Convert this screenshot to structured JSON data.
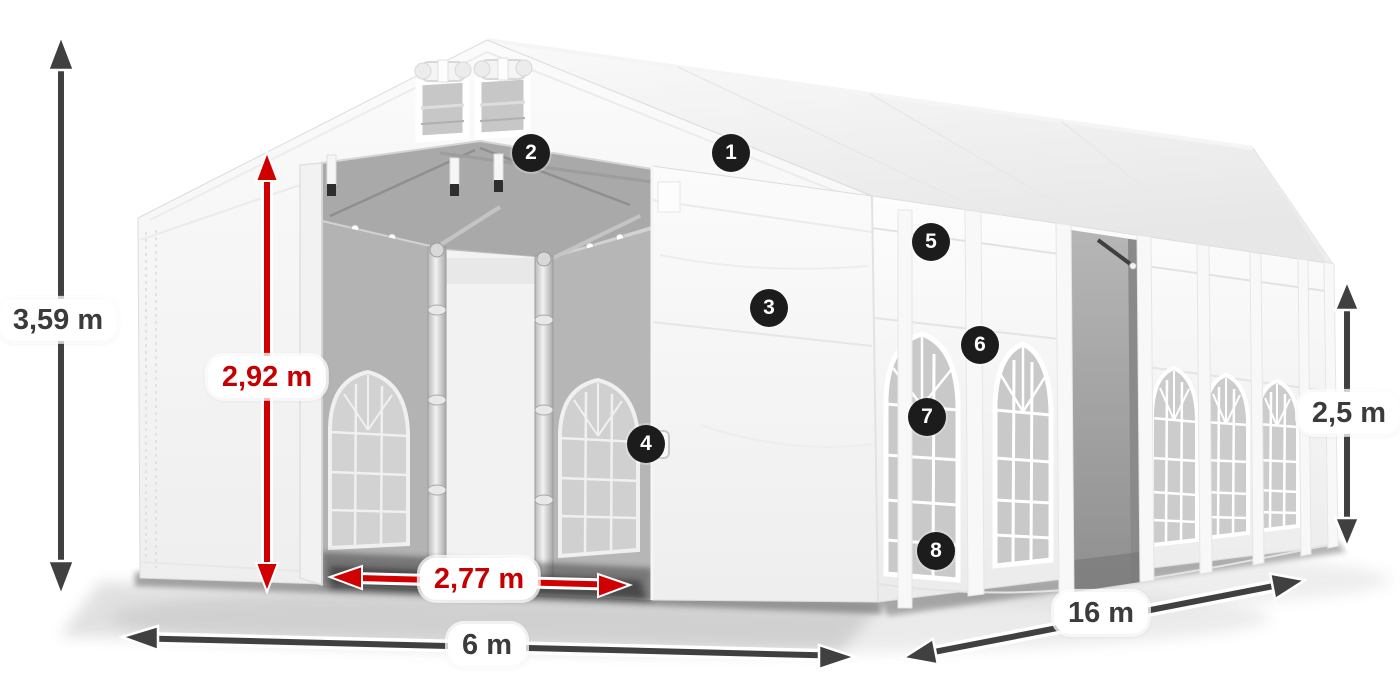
{
  "diagram": {
    "type": "product-dimension-diagram",
    "subject": "white marquee party tent 6 x 16 m with open entrance, roof vents, arched windows and side sliding door",
    "background_color": "#ffffff"
  },
  "colors": {
    "dimension_red": "#d10000",
    "dimension_dark": "#3f3f3f",
    "label_background": "#ffffff",
    "label_text_dark": "#3b3b3b",
    "label_text_red": "#c60000",
    "marker_background": "#1c1c1c",
    "marker_text": "#ffffff",
    "tent_white": "#f7f7f7"
  },
  "dimensions": {
    "total_height": {
      "label": "3,59 m",
      "style": "dark",
      "orientation": "vertical"
    },
    "clear_height": {
      "label": "2,92 m",
      "style": "red",
      "orientation": "vertical"
    },
    "entrance_width": {
      "label": "2,77 m",
      "style": "red",
      "orientation": "horizontal"
    },
    "width": {
      "label": "6 m",
      "style": "dark",
      "orientation": "horizontal"
    },
    "length": {
      "label": "16 m",
      "style": "dark",
      "orientation": "diagonal"
    },
    "side_height": {
      "label": "2,5 m",
      "style": "dark",
      "orientation": "vertical"
    }
  },
  "markers": [
    "1",
    "2",
    "3",
    "4",
    "5",
    "6",
    "7",
    "8"
  ]
}
